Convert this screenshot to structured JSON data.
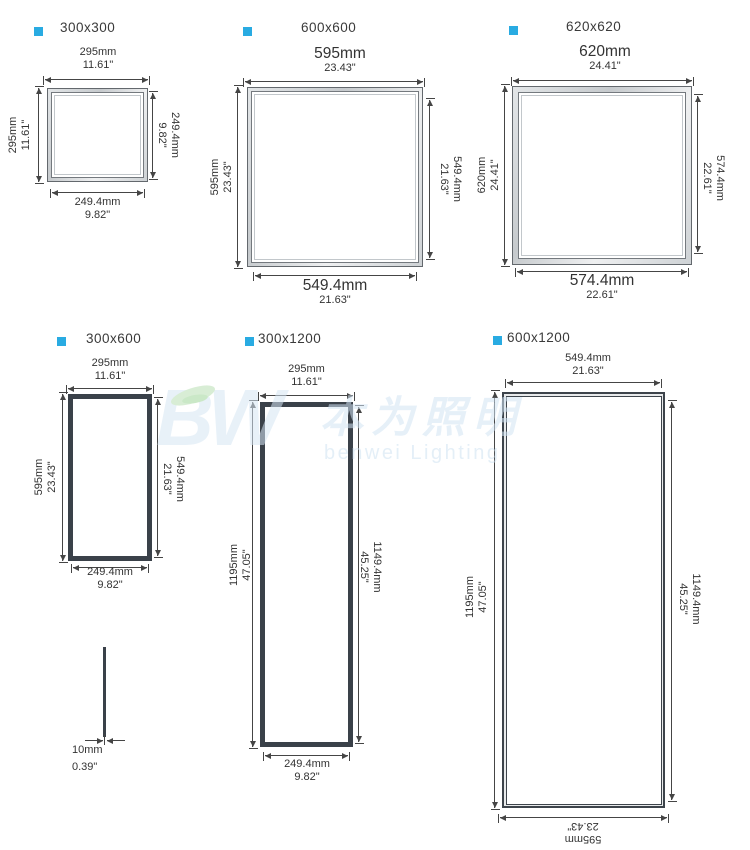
{
  "colors": {
    "accent": "#29abe2",
    "line": "#454545",
    "frame_dark": "#3a4149",
    "watermark_blue": "#d2e4f4",
    "watermark_green": "#b9e0b4"
  },
  "panels": [
    {
      "label": "300x300",
      "top": {
        "mm": "295mm",
        "in": "11.61\""
      },
      "left": {
        "mm": "295mm",
        "in": "11.61\""
      },
      "right": {
        "mm": "249.4mm",
        "in": "9.82\""
      },
      "bottom": {
        "mm": "249.4mm",
        "in": "9.82\""
      }
    },
    {
      "label": "600x600",
      "top": {
        "mm": "595mm",
        "in": "23.43\""
      },
      "left": {
        "mm": "595mm",
        "in": "23.43\""
      },
      "right": {
        "mm": "549.4mm",
        "in": "21.63\""
      },
      "bottom": {
        "mm": "549.4mm",
        "in": "21.63\""
      }
    },
    {
      "label": "620x620",
      "top": {
        "mm": "620mm",
        "in": "24.41\""
      },
      "left": {
        "mm": "620mm",
        "in": "24.41\""
      },
      "right": {
        "mm": "574.4mm",
        "in": "22.61\""
      },
      "bottom": {
        "mm": "574.4mm",
        "in": "22.61\""
      }
    },
    {
      "label": "300x600",
      "top": {
        "mm": "295mm",
        "in": "11.61\""
      },
      "left": {
        "mm": "595mm",
        "in": "23.43\""
      },
      "right": {
        "mm": "549.4mm",
        "in": "21.63\""
      },
      "bottom": {
        "mm": "249.4mm",
        "in": "9.82\""
      }
    },
    {
      "label": "300x1200",
      "top": {
        "mm": "295mm",
        "in": "11.61\""
      },
      "left": {
        "mm": "1195mm",
        "in": "47.05\""
      },
      "right": {
        "mm": "1149.4mm",
        "in": "45.25\""
      },
      "bottom": {
        "mm": "249.4mm",
        "in": "9.82\""
      }
    },
    {
      "label": "600x1200",
      "top": {
        "mm": "549.4mm",
        "in": "21.63\""
      },
      "left": {
        "mm": "1195mm",
        "in": "47.05\""
      },
      "right": {
        "mm": "1149.4mm",
        "in": "45.25\""
      },
      "bottom": {
        "mm": "595mm",
        "in": "23.43\""
      }
    }
  ],
  "thickness": {
    "mm": "10mm",
    "in": "0.39\""
  },
  "watermark": {
    "logo": "BW",
    "cjk": "本为照明",
    "text": "benwei Lighting"
  }
}
